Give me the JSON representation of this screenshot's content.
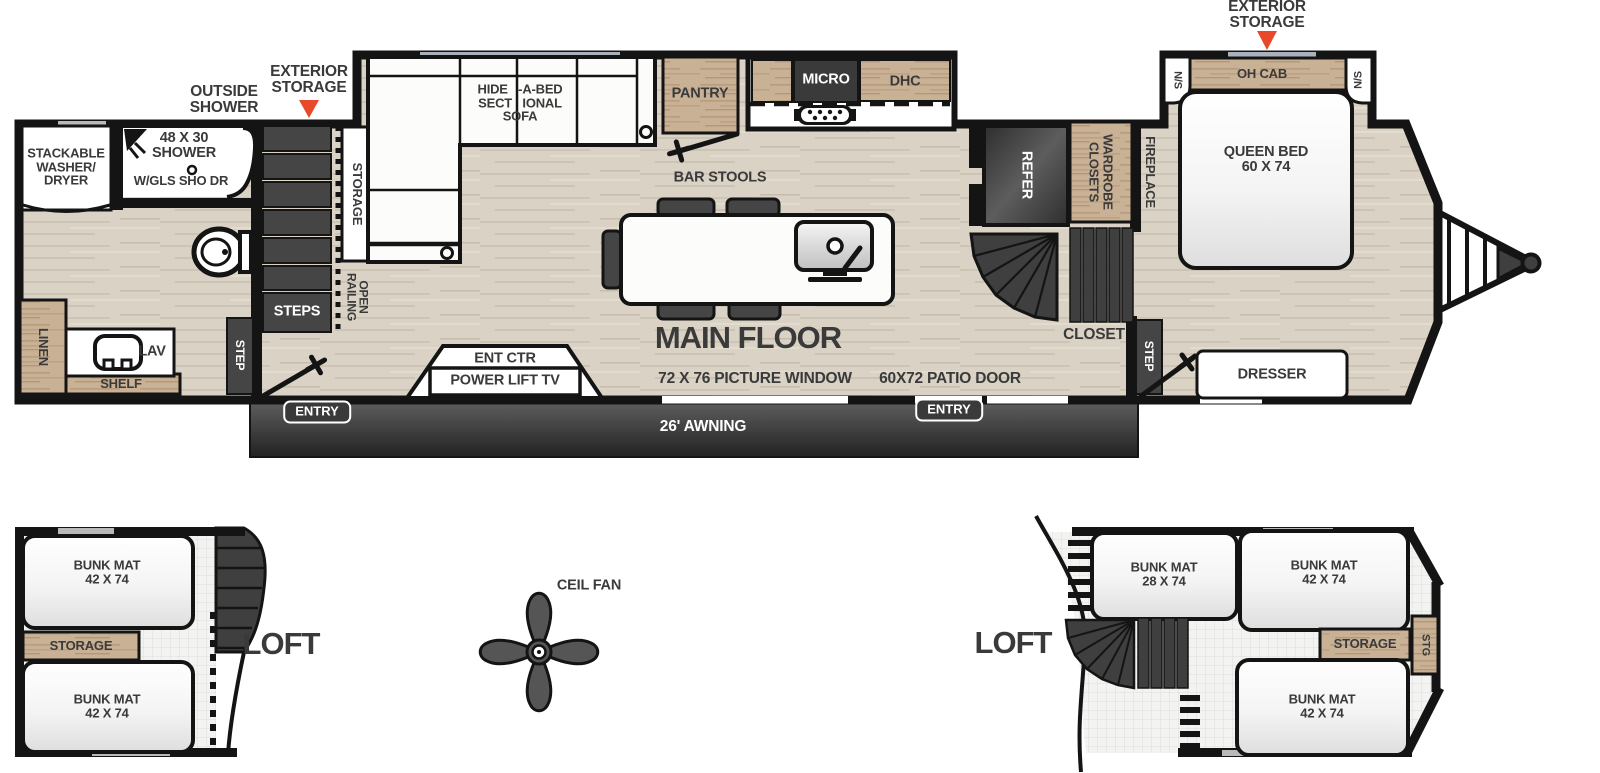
{
  "colors": {
    "wall": "#141414",
    "wood_floor": "#d9d2c5",
    "cabinet_wood": "#c9b195",
    "dark_fixture": "#454545",
    "accent_triangle": "#e8492b",
    "awning_dark": "#2b2b2b",
    "label_text": "#3a3a3a"
  },
  "main_floor": {
    "title": "MAIN FLOOR",
    "annotations": {
      "outside_shower": "OUTSIDE\nSHOWER",
      "exterior_storage_left": "EXTERIOR\nSTORAGE",
      "exterior_storage_right": "EXTERIOR\nSTORAGE"
    },
    "bathroom": {
      "washer_dryer": "STACKABLE\nWASHER/\nDRYER",
      "shower_size": "48 X 30\nSHOWER",
      "shower_door": "W/GLS SHO DR",
      "linen": "LINEN",
      "lav": "LAV",
      "shelf": "SHELF",
      "step": "STEP"
    },
    "stairs": {
      "steps": "STEPS",
      "open_railing": "OPEN\nRAILING",
      "storage": "STORAGE"
    },
    "living": {
      "sofa": "HIDE -A-BED\nSECT IONAL\nSOFA",
      "bar_stools": "BAR STOOLS",
      "ent_ctr": "ENT CTR",
      "power_lift_tv": "POWER LIFT TV",
      "picture_window": "72 X 76 PICTURE WINDOW"
    },
    "kitchen": {
      "pantry": "PANTRY",
      "micro": "MICRO",
      "dhc": "DHC",
      "refer": "REFER"
    },
    "rear_hall": {
      "wardrobe_closets": "WARDROBE\nCLOSETS",
      "fireplace": "FIREPLACE",
      "closet": "CLOSET",
      "step": "STEP",
      "patio_door": "60X72 PATIO DOOR"
    },
    "bedroom": {
      "oh_cab": "OH CAB",
      "ns_left": "N/S",
      "ns_right": "N/S",
      "queen_bed": "QUEEN BED\n60 X 74",
      "dresser": "DRESSER"
    },
    "exterior": {
      "awning": "26' AWNING",
      "entry_front": "ENTRY",
      "entry_rear": "ENTRY"
    }
  },
  "ceiling_fan": {
    "label": "CEIL FAN"
  },
  "loft_left": {
    "title": "LOFT",
    "bunk_top": "BUNK MAT\n42 X 74",
    "storage": "STORAGE",
    "bunk_bottom": "BUNK MAT\n42 X 74"
  },
  "loft_right": {
    "title": "LOFT",
    "bunk_side": "BUNK MAT\n28 X 74",
    "bunk_top": "BUNK MAT\n42 X 74",
    "storage": "STORAGE",
    "stg": "STG",
    "bunk_bottom": "BUNK MAT\n42 X 74"
  }
}
